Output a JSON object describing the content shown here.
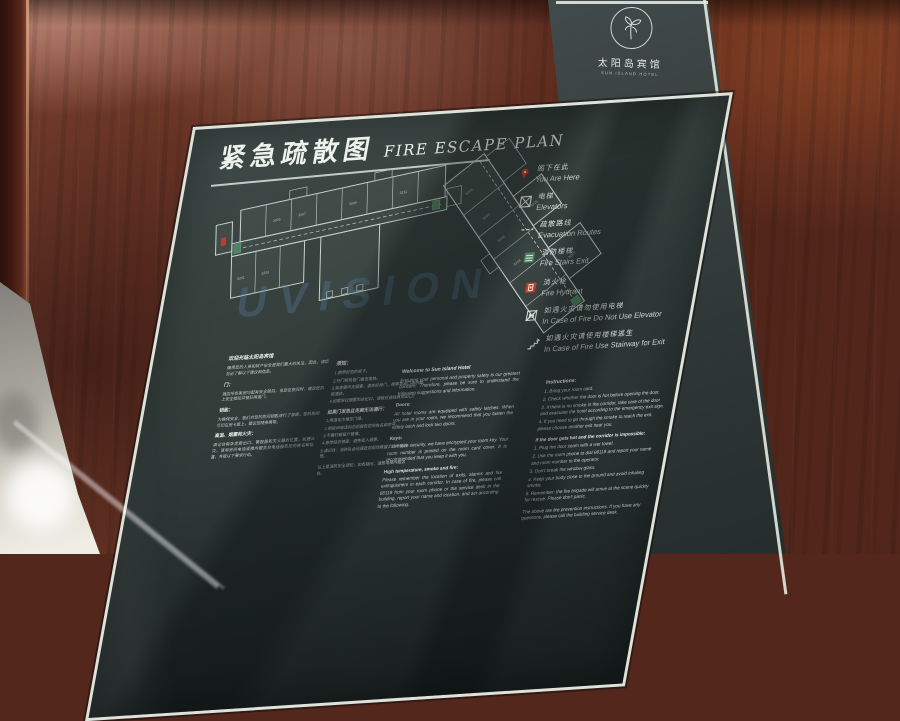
{
  "logo": {
    "name_zh": "太阳岛宾馆",
    "name_en": "SUN ISLAND HOTEL"
  },
  "sign": {
    "title_zh": "紧急疏散图",
    "title_en": "FIRE ESCAPE PLAN",
    "watermark": "UVISION",
    "legend": [
      {
        "icon": "you-are-here",
        "zh": "阁下在此",
        "en": "You Are Here"
      },
      {
        "icon": "elevator",
        "zh": "电梯",
        "en": "Elevators"
      },
      {
        "icon": "evacuation-route",
        "zh": "疏散路线",
        "en": "Evacuation Routes"
      },
      {
        "icon": "fire-stairs",
        "zh": "消防楼梯",
        "en": "Fire Stairs Exit"
      },
      {
        "icon": "fire-hydrant",
        "zh": "消火栓",
        "en": "Fire Hydrant"
      },
      {
        "icon": "no-elevator",
        "zh": "如遇火灾请勿使用电梯",
        "en": "In Case of Fire Do Not Use Elevator"
      },
      {
        "icon": "stairway-exit",
        "zh": "如遇火灾请使用楼梯逃生",
        "en": "In Case of Fire Use Stairway for Exit"
      }
    ],
    "floor_plan": {
      "rooms": [
        "3201",
        "3203",
        "3205",
        "3207",
        "3209",
        "3211",
        "3213",
        "3215",
        "3216",
        "3218",
        "3219",
        "3226",
        "3227"
      ]
    },
    "columns": {
      "zh_welcome": {
        "heading": "欢迎光临太阳岛宾馆",
        "intro": "确保您的人身和财产安全是我们最大的关注，因此，请您务必了解以下建议和信息。",
        "s1_title": "门：",
        "s1": "酒店所有客房均配有安全锁扣，当您在房间时，建议您扣上安全锁扣并锁好两道门。",
        "s2_title": "钥匙：",
        "s2": "为确保安全，我们对您的房间钥匙进行了加密，您的房间号印在房卡套上，建议您随身携带。",
        "s3_title": "高温、烟雾和火灾：",
        "s3": "请记住每条走廊出口、警报器和灭火器的位置。如遇火灾，请用房间电话或楼内服务台电话报告您的姓名和位置，并按以下要求行动。"
      },
      "zh_instructions": {
        "heading": "须知：",
        "items": [
          "1.携带好您的房卡。",
          "2.开门前检查门是否发热。",
          "3.如走廊内无烟雾，请关好房门，按紧急出口指示撤离酒店。",
          "4.如需穿过烟雾到达出口，请就近选择其他出口。"
        ],
        "heading2": "如果门发热且走廊无法通行：",
        "items2": [
          "1.用湿毛巾堵住门缝。",
          "2.用房间电话向总机报告您的姓名和房号。",
          "3.不要打破窗户玻璃。",
          "4.身体贴近地面，避免吸入烟雾。",
          "5.请记住：消防队会迅速赶到现场救援，请不要惊慌。"
        ],
        "footer": "以上是消防安全须知，如有疑问，请致电楼内服务台。"
      },
      "en_welcome": {
        "heading": "Welcome to Sun Island Hotel",
        "intro": "Ensuring your personal and property safety is our greatest concern. Therefore, please be sure to understand the following suggestions and information.",
        "s1_title": "Doors:",
        "s1": "All hotel rooms are equipped with safety latches. When you are in your room, we recommend that you fasten the safety latch and lock two doors.",
        "s2_title": "Keys:",
        "s2": "To ensure security, we have encrypted your room key. Your room number is printed on the room card cover. It is recommended that you keep it with you.",
        "s3_title": "High temperature, smoke and fire:",
        "s3": "Please remember the location of exits, alarms and fire extinguishers in each corridor. In case of fire, please call 88119 from your room phone or the service desk in the building, report your name and location, and act according to the following."
      },
      "en_instructions": {
        "heading": "Instructions:",
        "items": [
          "1. Bring your room card.",
          "2. Check whether the door is hot before opening the door.",
          "3. If there is no smoke in the corridor, take care of the door and evacuate the hotel according to the emergency exit sign.",
          "4. If you need to go through the smoke to reach the exit, please choose another exit near you."
        ],
        "heading2": "If the door gets hot and the corridor is impossible:",
        "items2": [
          "1. Plug the door seam with a wet towel.",
          "2. Use the room phone to dial 88119 and report your name and room number to the operator.",
          "3. Don't break the window glass.",
          "4. Keep your body close to the ground and avoid inhaling smoke.",
          "5. Remember: the fire brigade will arrive at the scene quickly for rescue. Please don't panic."
        ],
        "footer": "The above are fire prevention instructions. If you have any questions, please call the building service desk."
      }
    }
  },
  "colors": {
    "panel": "#2f3a38",
    "frame": "#dde2da",
    "accent_red": "#c43b2a",
    "accent_green": "#4e8262",
    "wood": "#6b3526",
    "watermark_blue": "#608ab8"
  }
}
